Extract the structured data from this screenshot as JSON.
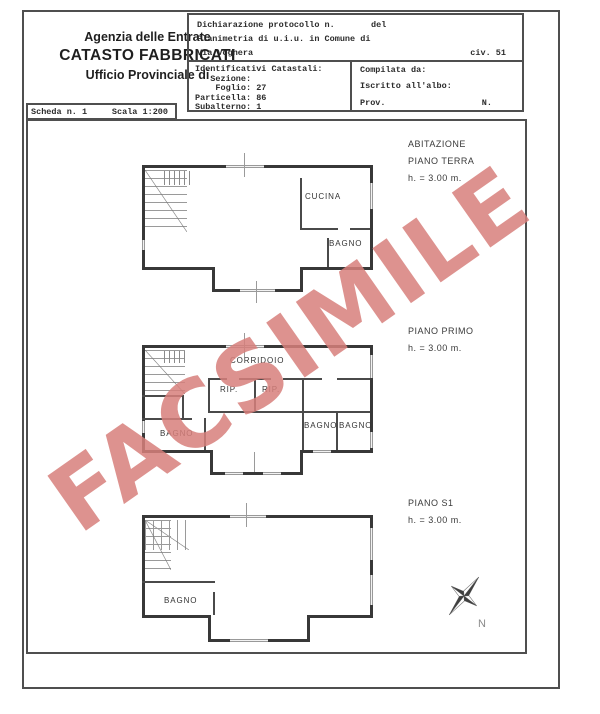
{
  "document": {
    "agency": {
      "line1": "Agenzia delle Entrate",
      "line2": "CATASTO FABBRICATI",
      "line3": "Ufficio Provinciale di"
    },
    "declaration": {
      "protocol_label": "Dichiarazione protocollo n.",
      "protocol_del": "del",
      "planimetria": "Planimetria di u.i.u. in Comune di",
      "street": "Via Voghera",
      "civ": "civ. 51",
      "cadastral_title": "Identificativi Catastali:",
      "cadastral_lines": [
        "   Sezione:",
        "    Foglio: 27",
        "Particella: 86",
        "Subalterno: 1"
      ],
      "compilata": "Compilata da:",
      "iscritto": "Iscritto all'albo:",
      "prov": "Prov.",
      "n": "N."
    },
    "sheet": {
      "number": "Scheda n. 1",
      "scale": "Scala 1:200"
    }
  },
  "plans": [
    {
      "labels": [
        "ABITAZIONE",
        "PIANO TERRA",
        "h. = 3.00 m."
      ],
      "rooms": {
        "cucina": "CUCINA",
        "bagno": "BAGNO"
      }
    },
    {
      "labels": [
        "PIANO PRIMO",
        "h. = 3.00 m."
      ],
      "rooms": {
        "corridoio": "CORRIDOIO",
        "rip1": "RIP.",
        "rip2": "RIP.",
        "bagno_left": "BAGNO",
        "bagno_mid": "BAGNO",
        "bagno_right": "BAGNO"
      }
    },
    {
      "labels": [
        "PIANO S1",
        "h. = 3.00 m."
      ],
      "rooms": {
        "bagno": "BAGNO"
      }
    }
  ],
  "watermark": {
    "text": "FACSIMILE",
    "color": "#d8807c"
  },
  "compass": {
    "label": "N"
  }
}
